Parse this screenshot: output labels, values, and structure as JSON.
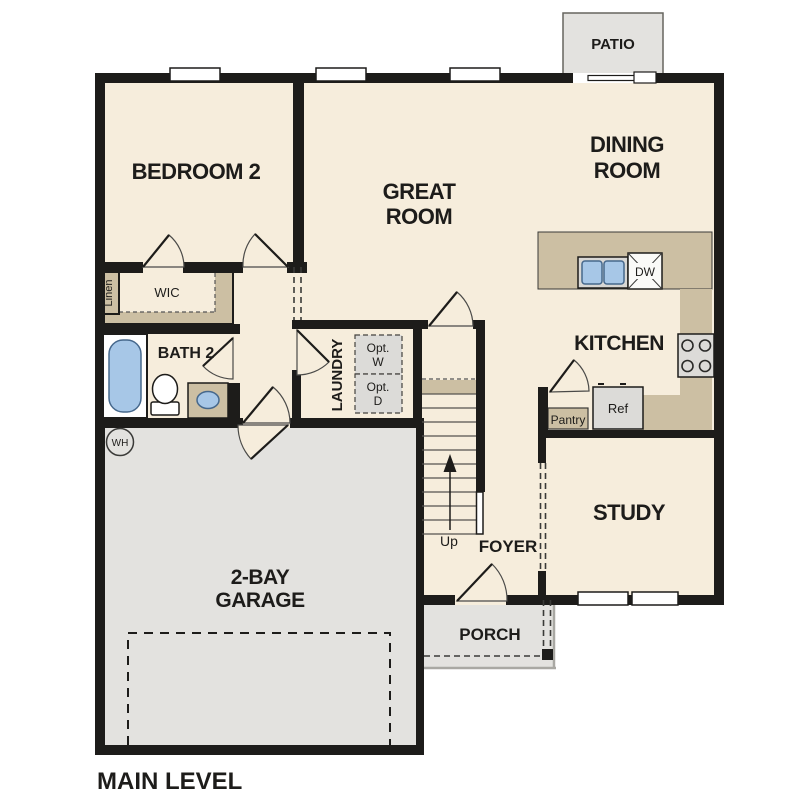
{
  "plan_title": "MAIN LEVEL",
  "rooms": {
    "bedroom2": {
      "label": "BEDROOM 2"
    },
    "great_room": {
      "line1": "GREAT",
      "line2": "ROOM"
    },
    "dining_room": {
      "line1": "DINING",
      "line2": "ROOM"
    },
    "kitchen": {
      "label": "KITCHEN"
    },
    "study": {
      "label": "STUDY"
    },
    "foyer": {
      "label": "FOYER"
    },
    "porch": {
      "label": "PORCH"
    },
    "patio": {
      "label": "PATIO"
    },
    "garage": {
      "line1": "2-BAY",
      "line2": "GARAGE"
    },
    "laundry": {
      "label": "LAUNDRY"
    },
    "bath2": {
      "label": "BATH 2"
    },
    "wic": {
      "label": "WIC"
    },
    "linen": {
      "label": "Linen"
    },
    "pantry": {
      "label": "Pantry"
    }
  },
  "fixtures": {
    "dishwasher": "DW",
    "refrigerator": "Ref",
    "water_heater": "WH",
    "opt_washer_line1": "Opt.",
    "opt_washer_line2": "W",
    "opt_dryer_line1": "Opt.",
    "opt_dryer_line2": "D",
    "stairs_direction": "Up"
  },
  "palette": {
    "floor_cream": "#f6eddc",
    "counter_tan": "#ccbfa3",
    "exterior_gray": "#e3e2df",
    "appliance_gray": "#dcdbd8",
    "fixture_blue": "#a7c7e7",
    "wall_black": "#1d1c1a"
  }
}
